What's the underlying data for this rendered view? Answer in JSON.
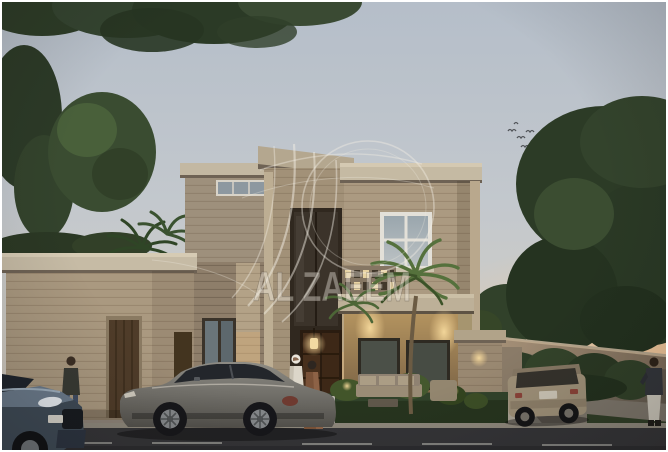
{
  "image": {
    "type": "architectural exterior render (real-estate listing photo)",
    "description": "Front elevation of a two-storey beige villa at dusk with landscaped front yard, parked cars, boundary wall and pedestrians",
    "time_of_day": "dusk",
    "width_px": 668,
    "height_px": 452
  },
  "watermark": {
    "text": "AL ZAEEM",
    "logo": "falcon-swoosh with circular arc, translucent white overlay centered on the facade"
  },
  "scene": {
    "building": {
      "style": "modern classic villa, beige stucco with horizontal banding and stone cornices",
      "elements": [
        "single-storey left wing with wooden garage door",
        "upper-left block with clerestory strip window",
        "tall central entrance tower with dark recessed glazing",
        "dark wooden double entrance door with glowing pendant lantern",
        "right wing with white 4-pane window",
        "perforated lit parapet screen",
        "porch canopy with warm downlights and glazed doors",
        "small side gate block with wall sconce"
      ],
      "boundary": "long stucco compound wall receding to the right with hedge in front"
    },
    "vehicles": [
      {
        "name": "grey-sedan",
        "position": "parked on road in front of entrance, facing left"
      },
      {
        "name": "blue-suv",
        "position": "bottom-left corner, front partially in frame"
      },
      {
        "name": "beige-suv",
        "position": "parked on right driveway near compound wall, seen from rear"
      }
    ],
    "people": [
      {
        "name": "pedestrian-left",
        "description": "man in dark jacket and jeans walking along left sidewalk"
      },
      {
        "name": "man-in-thobe",
        "description": "man in white thobe and ghutra at the entrance lawn"
      },
      {
        "name": "woman-in-abaya",
        "description": "woman in brown abaya beside him"
      },
      {
        "name": "pedestrian-right",
        "description": "man in dark top and light trousers standing at far right"
      }
    ],
    "vegetation": [
      "overhanging branches along top edge",
      "tall dark tree far left",
      "round green tree upper left",
      "palms behind left wing",
      "coconut palm in front of right-wing window",
      "large dark tree canopy upper right",
      "hedge along boundary wall",
      "lit garden shrubs and white flowering plant on lawn"
    ],
    "sky": {
      "condition": "pale grey-blue dusk sky",
      "details": [
        "flock of birds upper right",
        "warm sunset glow at right horizon"
      ]
    },
    "street": [
      "dark asphalt road across bottom with faint dashed centre line",
      "light kerb",
      "white bollard at lawn edge",
      "outdoor sofa set with coffee table on lawn"
    ]
  },
  "colors": {
    "sky_top": "#b5bec9",
    "sunset_glow": "#f0bc8c",
    "facade": "#ab9a81",
    "facade_shadow": "#8e7e6a",
    "cornice": "#c6bba5",
    "entrance_door_wood": "#472f1c",
    "warm_light": "#f0d49e",
    "lawn": "#26341e",
    "foliage": "#2e3d28",
    "road": "#333336",
    "boundary_wall": "#9a8b77",
    "sedan": "#76746e",
    "suv_blue": "#5a6a7c",
    "suv_beige": "#9e9078",
    "watermark_fill": "rgba(240,235,226,0.40)"
  }
}
